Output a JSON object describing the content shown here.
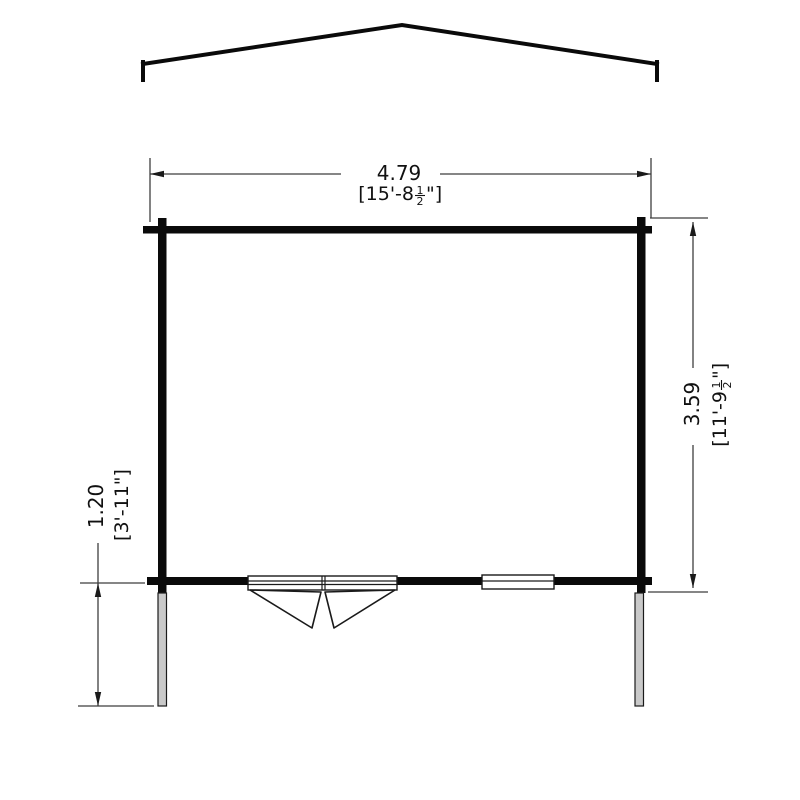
{
  "drawing": {
    "type": "log-cabin-floor-plan",
    "colors": {
      "outline": "#0a0a0a",
      "dimension_line": "#3f3f3f",
      "post_fill": "#c9c9c9",
      "background": "#ffffff"
    },
    "dim_width": {
      "metric": "4.79",
      "imp_prefix": "[15'-8",
      "frac_num": "1",
      "frac_den": "2",
      "imp_suffix": "\"]"
    },
    "dim_depth": {
      "metric": "3.59",
      "imp_prefix": "[11'-9",
      "frac_num": "1",
      "frac_den": "2",
      "imp_suffix": "\"]"
    },
    "dim_canopy": {
      "metric": "1.20",
      "imperial": "[3'-11\"]"
    }
  }
}
